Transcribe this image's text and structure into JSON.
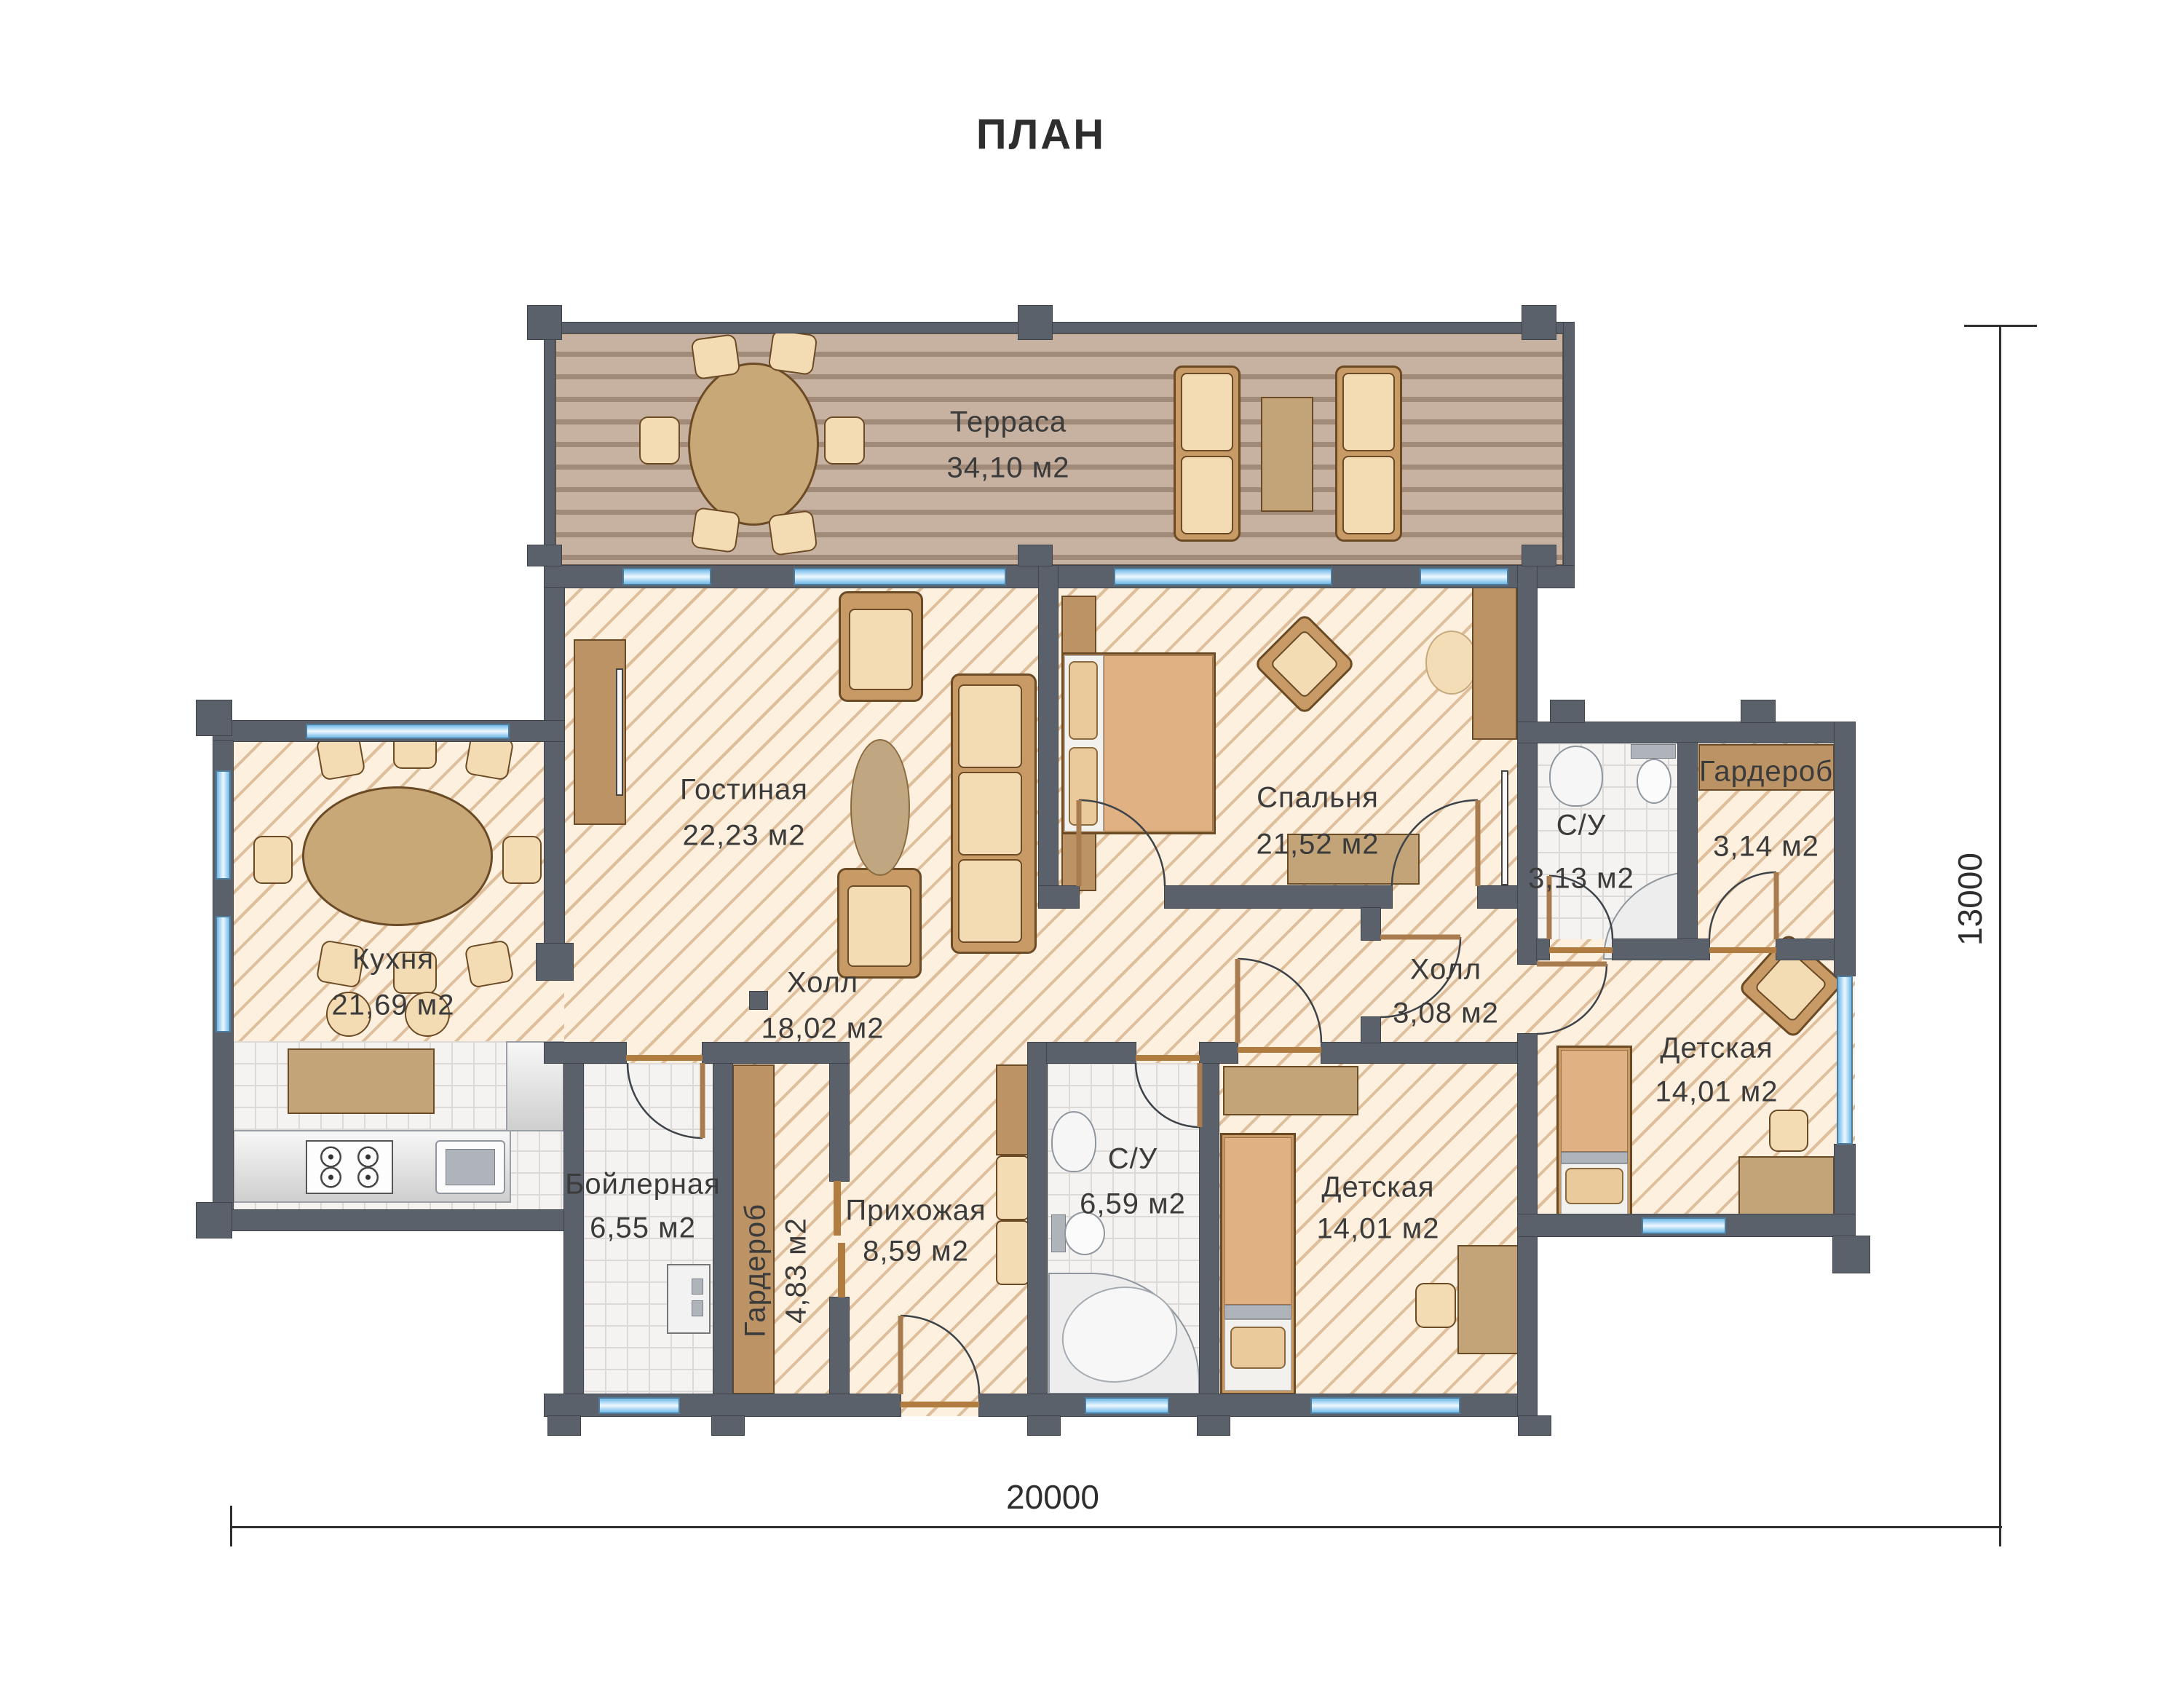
{
  "title": "ПЛАН",
  "rooms": [
    {
      "id": "terrace",
      "name": "Терраса",
      "area": "34,10 м2"
    },
    {
      "id": "living",
      "name": "Гостиная",
      "area": "22,23 м2"
    },
    {
      "id": "bedroom",
      "name": "Спальня",
      "area": "21,52 м2"
    },
    {
      "id": "bath-small",
      "name": "С/У",
      "area": "3,13 м2"
    },
    {
      "id": "wardrobe-small",
      "name": "Гардероб",
      "area": "3,14 м2"
    },
    {
      "id": "kitchen",
      "name": "Кухня",
      "area": "21,69 м2"
    },
    {
      "id": "hall-main",
      "name": "Холл",
      "area": "18,02 м2"
    },
    {
      "id": "hall-small",
      "name": "Холл",
      "area": "3,08 м2"
    },
    {
      "id": "kids-right",
      "name": "Детская",
      "area": "14,01 м2"
    },
    {
      "id": "boiler",
      "name": "Бойлерная",
      "area": "6,55 м2"
    },
    {
      "id": "wardrobe-vert",
      "name": "Гардероб",
      "area": "4,83 м2"
    },
    {
      "id": "entry",
      "name": "Прихожая",
      "area": "8,59 м2"
    },
    {
      "id": "bath-big",
      "name": "С/У",
      "area": "6,59 м2"
    },
    {
      "id": "kids-bottom",
      "name": "Детская",
      "area": "14,01 м2"
    }
  ],
  "dimensions": {
    "width": "20000",
    "height": "13000"
  },
  "colors": {
    "wall": "#5a616a",
    "floor": "#fdf0de",
    "hatch": "#c69664",
    "deck": "#c7b2a1",
    "window": "#6fb9e8",
    "furniture_wood": "#c2a478",
    "furniture_light": "#f3dcb4",
    "text": "#3b3b3b"
  }
}
